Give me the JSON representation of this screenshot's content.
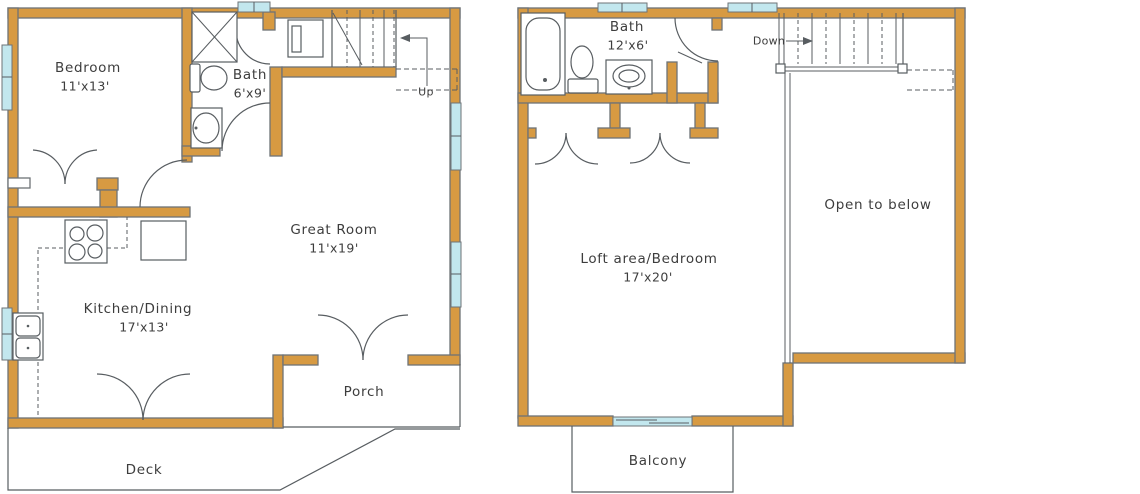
{
  "colors": {
    "wall": "#d79a42",
    "outline": "#6e7377",
    "window": "#c2e7ee",
    "line": "#585d61",
    "text": "#3d3d3d",
    "paper": "#ffffff"
  },
  "floor1": {
    "bedroom_name": "Bedroom",
    "bedroom_dims": "11'x13'",
    "bath_name": "Bath",
    "bath_dims": "6'x9'",
    "great_room_name": "Great Room",
    "great_room_dims": "11'x19'",
    "kitchen_name": "Kitchen/Dining",
    "kitchen_dims": "17'x13'",
    "porch_name": "Porch",
    "deck_name": "Deck",
    "stair_label": "Up"
  },
  "floor2": {
    "bath_name": "Bath",
    "bath_dims": "12'x6'",
    "loft_name": "Loft area/Bedroom",
    "loft_dims": "17'x20'",
    "open_name": "Open to below",
    "balcony_name": "Balcony",
    "stair_label": "Down"
  }
}
